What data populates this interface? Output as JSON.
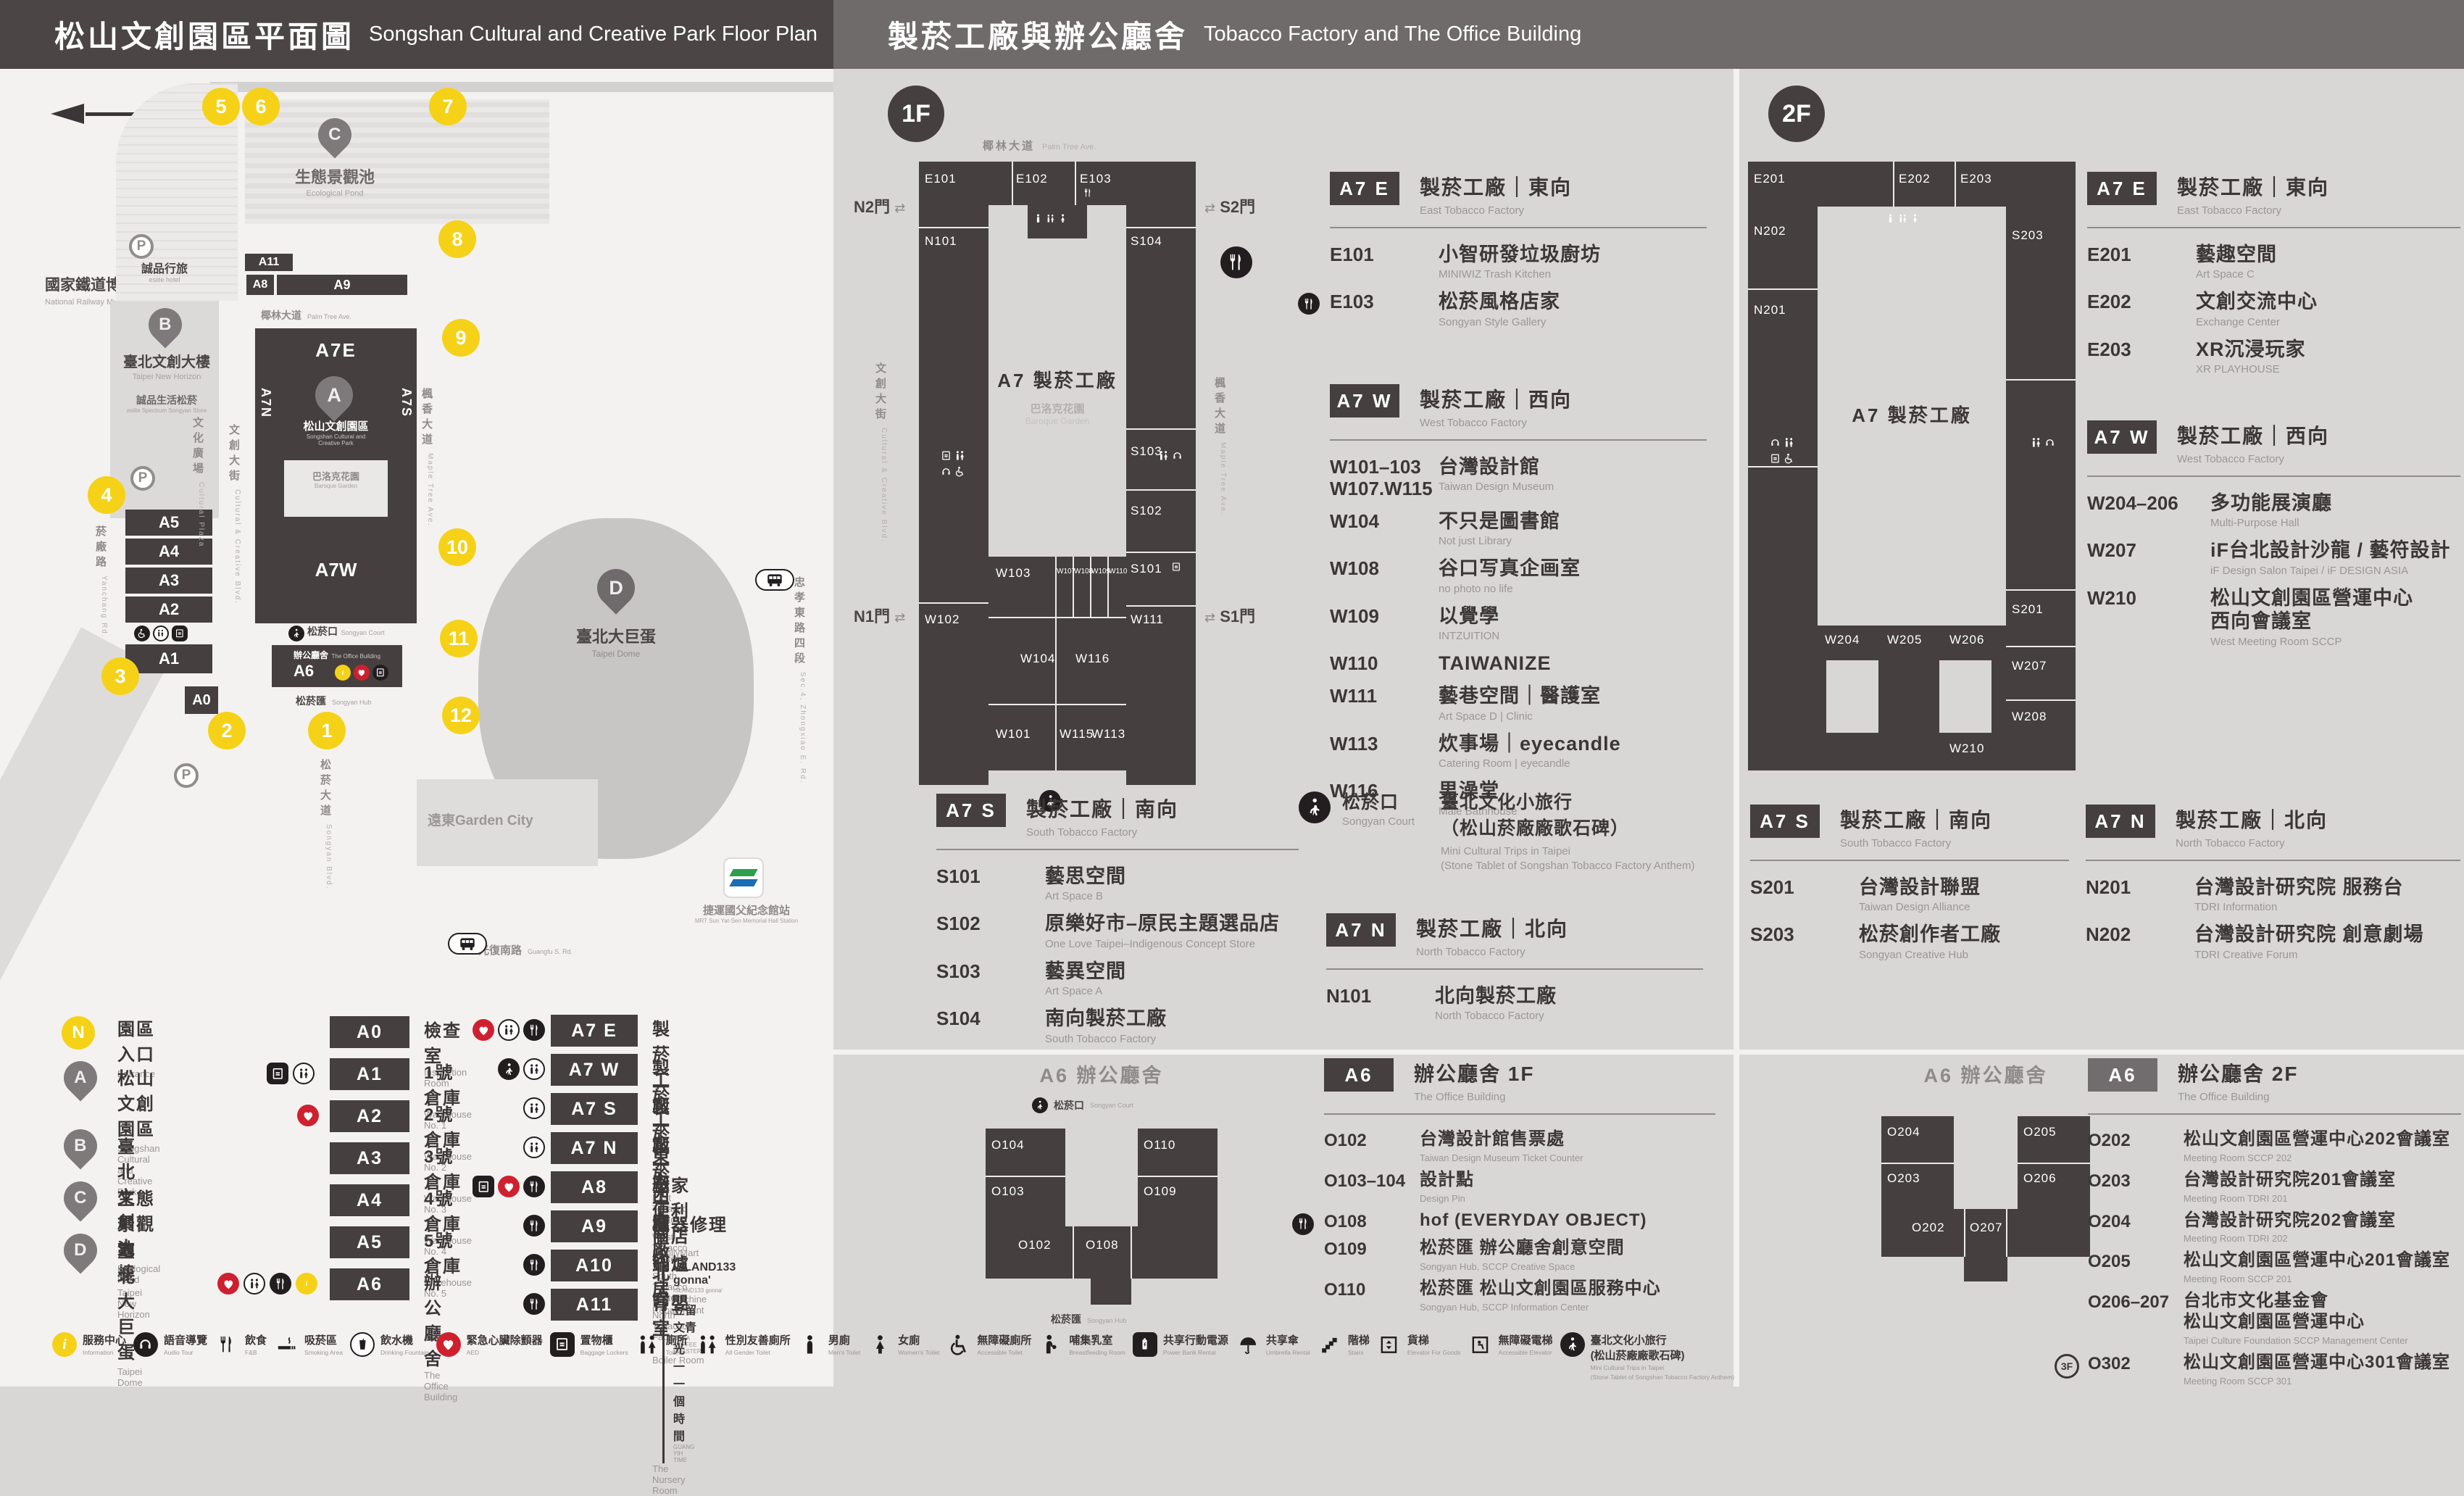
{
  "header": {
    "left_zh": "松山文創園區平面圖",
    "left_en": "Songshan Cultural and Creative Park Floor Plan",
    "right_zh": "製菸工廠與辦公廳舍",
    "right_en": "Tobacco Factory and The Office Building"
  },
  "map": {
    "parking": "P",
    "landmarks": {
      "railway_zh": "國家鐵道博物館",
      "railway_en": "National Railway Museum",
      "eslite_hotel_zh": "誠品行旅",
      "eslite_hotel_en": "eslite hotel",
      "horizon_zh": "臺北文創大樓",
      "horizon_en": "Taipei New Horizon",
      "spectrum_zh": "誠品生活松菸",
      "spectrum_en": "eslite Spectrum Songyan Store",
      "pond_zh": "生態景觀池",
      "pond_en": "Ecological Pond",
      "park_zh": "松山文創園區",
      "park_en1": "Songshan Cultural and",
      "park_en2": "Creative Park",
      "dome_zh": "臺北大巨蛋",
      "dome_en": "Taipei Dome",
      "baroque_zh": "巴洛克花園",
      "baroque_en": "Baroque Garden",
      "court_zh": "松菸口",
      "court_en": "Songyan Court",
      "office_zh": "辦公廳舍",
      "office_en": "The Office Building",
      "hub_zh": "松菸匯",
      "hub_en": "Songyan Hub",
      "mrt_zh": "捷運國父紀念館站",
      "mrt_en": "MRT Sun Yat-Sen Memorial Hall Station",
      "garden_city": "遠東Garden City"
    },
    "streets": {
      "palm_zh": "椰林大道",
      "palm_en": "Palm Tree Ave.",
      "plaza_zh": "文化廣場",
      "plaza_en": "Cultural Plaza",
      "ccblvd_zh": "文創大街",
      "ccblvd_en": "Cultural & Creative Blvd.",
      "maple_zh": "楓香大道",
      "maple_en": "Maple Tree Ave.",
      "yanchang_zh": "菸廠路",
      "yanchang_en": "Yanchang Rd.",
      "guangfu_zh": "光復南路",
      "guangfu_en": "Guangfu S. Rd.",
      "zhongxiao_zh": "忠孝東路四段",
      "zhongxiao_en": "Sec.4, Zhongxiao E. Rd.",
      "songyan_zh": "松菸大道",
      "songyan_en": "Songyan Blvd."
    },
    "blabels": {
      "a11": "A11",
      "a8": "A8",
      "a9": "A9",
      "a7e": "A7E",
      "a7n": "A7N",
      "a7s": "A7S",
      "a7w": "A7W",
      "a6": "A6",
      "a0": "A0",
      "a1": "A1",
      "a2": "A2",
      "a3": "A3",
      "a4": "A4",
      "a5": "A5"
    },
    "entrances": [
      "1",
      "2",
      "3",
      "4",
      "5",
      "6",
      "7",
      "8",
      "9",
      "10",
      "11",
      "12"
    ]
  },
  "legend": {
    "pins": [
      {
        "key": "N",
        "zh": "園區入口",
        "en": "Entrance"
      },
      {
        "key": "A",
        "zh": "松山文創園區",
        "en": "Songshan Cultural",
        "en2": "and Creative Park"
      },
      {
        "key": "B",
        "zh": "臺北文創大樓",
        "en": "Taipei New Horizon"
      },
      {
        "key": "C",
        "zh": "生態景觀池",
        "en": "Ecological Pond"
      },
      {
        "key": "D",
        "zh": "臺北大巨蛋",
        "en": "Taipei Dome"
      }
    ],
    "groupA": [
      {
        "code": "A0",
        "zh": "檢查室",
        "en": "Inspection Room"
      },
      {
        "code": "A1",
        "zh": "1號倉庫",
        "en": "Warehouse No. 1"
      },
      {
        "code": "A2",
        "zh": "2號倉庫",
        "en": "Warehouse No. 2"
      },
      {
        "code": "A3",
        "zh": "3號倉庫",
        "en": "Warehouse No. 3"
      },
      {
        "code": "A4",
        "zh": "4號倉庫",
        "en": "Warehouse No. 4"
      },
      {
        "code": "A5",
        "zh": "5號倉庫",
        "en": "Warehouse No. 5"
      },
      {
        "code": "A6",
        "zh": "辦公廳舍",
        "en": "The Office Building"
      }
    ],
    "groupB": [
      {
        "code": "A7 E",
        "zh": "製菸工廠｜東向",
        "en": "East Tobacco Factory"
      },
      {
        "code": "A7 W",
        "zh": "製菸工廠｜西向",
        "en": "West Tobacco Factory"
      },
      {
        "code": "A7 S",
        "zh": "製菸工廠｜南向",
        "en": "South Tobacco Factory"
      },
      {
        "code": "A7 N",
        "zh": "製菸工廠｜北向",
        "en": "North Tobacco Factory"
      },
      {
        "code": "A8",
        "zh": "全家便利商店",
        "en": "FamilyMart"
      },
      {
        "code": "A9",
        "zh": "機器修理廠",
        "extra_zh": "ISLAND133 gonna'",
        "extra_en": "ISLAND133 gonna'",
        "en": "The Machine Repair Plant"
      },
      {
        "code": "A10",
        "zh": "鍋爐房",
        "extra_zh": "豆留文青",
        "extra_en": "CAMA COFFEE ROASTERS",
        "en": "Boiler Room"
      },
      {
        "code": "A11",
        "zh": "育嬰室",
        "extra_zh": "光一 一個時間",
        "extra_en": "GUANG YIH TIME",
        "en": "The Nursery Room"
      }
    ]
  },
  "facilities": [
    {
      "zh": "服務中心",
      "en": "Information"
    },
    {
      "zh": "語音導覽",
      "en": "Audio Tour"
    },
    {
      "zh": "飲食",
      "en": "F&B"
    },
    {
      "zh": "吸菸區",
      "en": "Smoking Area"
    },
    {
      "zh": "飲水機",
      "en": "Drinking Fountain"
    },
    {
      "zh": "緊急心臟除顫器",
      "en": "AED"
    },
    {
      "zh": "置物櫃",
      "en": "Baggage Lockers"
    },
    {
      "zh": "廁所",
      "en": "Toilet"
    },
    {
      "zh": "性別友善廁所",
      "en": "All Gender Toilet"
    },
    {
      "zh": "男廁",
      "en": "Men's Toilet"
    },
    {
      "zh": "女廁",
      "en": "Women's Toilet"
    },
    {
      "zh": "無障礙廁所",
      "en": "Accessible Toilet"
    },
    {
      "zh": "哺集乳室",
      "en": "Breastfeeding Room"
    },
    {
      "zh": "共享行動電源",
      "en": "Power Bank Rental"
    },
    {
      "zh": "共享傘",
      "en": "Umbrella Rental"
    },
    {
      "zh": "階梯",
      "en": "Stairs"
    },
    {
      "zh": "貨梯",
      "en": "Elevator For Goods"
    },
    {
      "zh": "無障礙電梯",
      "en": "Accessible Elevator"
    },
    {
      "zh": "臺北文化小旅行",
      "zh2": "(松山菸廠廠歌石碑)",
      "en": "Mini Cultural Trips in Taipei",
      "en2": "(Stone Tablet of Songshan Tobacco Factory Anthem)"
    }
  ],
  "floor1": {
    "badge": "1F",
    "plan": {
      "street_top_zh": "椰林大道",
      "street_top_en": "Palm Tree Ave.",
      "street_left_zh": "文創大街",
      "street_left_en": "Cultural & Creative Blvd.",
      "street_right_zh": "楓香大道",
      "street_right_en": "Maple Tree Ave.",
      "gate_n2": "N2門",
      "gate_s2": "S2門",
      "gate_n1": "N1門",
      "gate_s1": "S1門",
      "center": "A7 製菸工廠",
      "garden_zh": "巴洛克花園",
      "garden_en": "Baroque Garden",
      "rooms": [
        "E101",
        "E102",
        "E103",
        "N101",
        "S104",
        "S103",
        "S102",
        "S101",
        "W102",
        "W103",
        "W104",
        "W107",
        "W108",
        "W109",
        "W110",
        "W111",
        "W116",
        "W101",
        "W115",
        "W113"
      ]
    },
    "a7e": {
      "badge": "A7 E",
      "tzh": "製菸工廠｜東向",
      "ten": "East Tobacco Factory",
      "rooms": [
        {
          "code": "E101",
          "zh": "小智研發垃圾廚坊",
          "en": "MINIWIZ Trash Kitchen"
        },
        {
          "code": "E103",
          "zh": "松菸風格店家",
          "en": "Songyan Style Gallery"
        }
      ]
    },
    "a7w": {
      "badge": "A7 W",
      "tzh": "製菸工廠｜西向",
      "ten": "West Tobacco Factory",
      "rooms": [
        {
          "code": "W101–103",
          "code2": "W107.W115",
          "zh": "台灣設計館",
          "en": "Taiwan Design Museum"
        },
        {
          "code": "W104",
          "zh": "不只是圖書館",
          "en": "Not just Library"
        },
        {
          "code": "W108",
          "zh": "谷口写真企画室",
          "en": "no photo no life"
        },
        {
          "code": "W109",
          "zh": "以覺學",
          "en": "INTZUITION"
        },
        {
          "code": "W110",
          "zh": "TAIWANIZE",
          "en": ""
        },
        {
          "code": "W111",
          "zh": "藝巷空間｜醫護室",
          "en": "Art Space D | Clinic"
        },
        {
          "code": "W113",
          "zh": "炊事場｜eyecandle",
          "en": "Catering Room | eyecandle"
        },
        {
          "code": "W116",
          "zh": "男澡堂",
          "en": "Male Bathhouse"
        }
      ]
    },
    "a7s": {
      "badge": "A7 S",
      "tzh": "製菸工廠｜南向",
      "ten": "South Tobacco Factory",
      "rooms": [
        {
          "code": "S101",
          "zh": "藝思空間",
          "en": "Art Space B"
        },
        {
          "code": "S102",
          "zh": "原樂好市–原民主題選品店",
          "en": "One Love Taipei–Indigenous Concept Store"
        },
        {
          "code": "S103",
          "zh": "藝異空間",
          "en": "Art Space A"
        },
        {
          "code": "S104",
          "zh": "南向製菸工廠",
          "en": "South Tobacco Factory"
        }
      ]
    },
    "court": {
      "zh": "松菸口",
      "en": "Songyan Court",
      "t1": "臺北文化小旅行",
      "t2": "（松山菸廠廠歌石碑）",
      "e1": "Mini Cultural Trips in Taipei",
      "e2": "(Stone Tablet of Songshan Tobacco Factory Anthem)"
    },
    "a7n": {
      "badge": "A7 N",
      "tzh": "製菸工廠｜北向",
      "ten": "North Tobacco Factory",
      "rooms": [
        {
          "code": "N101",
          "zh": "北向製菸工廠",
          "en": "North Tobacco Factory"
        }
      ]
    },
    "a6": {
      "badge": "A6",
      "tzh": "辦公廳舍 1F",
      "ten": "The Office Building",
      "rooms": [
        {
          "code": "O102",
          "zh": "台灣設計館售票處",
          "en": "Taiwan Design Museum Ticket Counter"
        },
        {
          "code": "O103–104",
          "zh": "設計點",
          "en": "Design Pin"
        },
        {
          "code": "O108",
          "zh": "hof (EVERYDAY OBJECT)",
          "en": ""
        },
        {
          "code": "O109",
          "zh": "松菸匯 辦公廳舍創意空間",
          "en": "Songyan Hub, SCCP Creative Space"
        },
        {
          "code": "O110",
          "zh": "松菸匯 松山文創園區服務中心",
          "en": "Songyan Hub, SCCP Information Center"
        }
      ]
    },
    "a6plan": {
      "title": "A6 辦公廳舍",
      "court_zh": "松菸口",
      "court_en": "Songyan Court",
      "hub_zh": "松菸匯",
      "hub_en": "Songyan Hub",
      "rooms": [
        "O104",
        "O103",
        "O102",
        "O110",
        "O109",
        "O108"
      ]
    }
  },
  "floor2": {
    "badge": "2F",
    "plan": {
      "center": "A7 製菸工廠",
      "rooms": [
        "E201",
        "E202",
        "E203",
        "N202",
        "N201",
        "S203",
        "S201",
        "W204",
        "W205",
        "W206",
        "W207",
        "W208",
        "W210"
      ]
    },
    "a7e": {
      "badge": "A7 E",
      "tzh": "製菸工廠｜東向",
      "ten": "East Tobacco Factory",
      "rooms": [
        {
          "code": "E201",
          "zh": "藝趣空間",
          "en": "Art Space C"
        },
        {
          "code": "E202",
          "zh": "文創交流中心",
          "en": "Exchange Center"
        },
        {
          "code": "E203",
          "zh": "XR沉浸玩家",
          "en": "XR PLAYHOUSE"
        }
      ]
    },
    "a7w": {
      "badge": "A7 W",
      "tzh": "製菸工廠｜西向",
      "ten": "West Tobacco Factory",
      "rooms": [
        {
          "code": "W204–206",
          "zh": "多功能展演廳",
          "en": "Multi-Purpose Hall"
        },
        {
          "code": "W207",
          "zh": "iF台北設計沙龍 / 藝符設計",
          "en": "iF Design Salon Taipei / iF DESIGN ASIA"
        },
        {
          "code": "W210",
          "zh": "松山文創園區營運中心",
          "zh2": "西向會議室",
          "en": "West Meeting Room SCCP"
        }
      ]
    },
    "a7s": {
      "badge": "A7 S",
      "tzh": "製菸工廠｜南向",
      "ten": "South Tobacco Factory",
      "rooms": [
        {
          "code": "S201",
          "zh": "台灣設計聯盟",
          "en": "Taiwan Design Alliance"
        },
        {
          "code": "S203",
          "zh": "松菸創作者工廠",
          "en": "Songyan Creative Hub"
        }
      ]
    },
    "a7n": {
      "badge": "A7 N",
      "tzh": "製菸工廠｜北向",
      "ten": "North Tobacco Factory",
      "rooms": [
        {
          "code": "N201",
          "zh": "台灣設計研究院 服務台",
          "en": "TDRI Information"
        },
        {
          "code": "N202",
          "zh": "台灣設計研究院 創意劇場",
          "en": "TDRI Creative Forum"
        }
      ]
    },
    "a6": {
      "badge": "A6",
      "tzh": "辦公廳舍 2F",
      "ten": "The Office Building",
      "rooms": [
        {
          "code": "O202",
          "zh": "松山文創園區營運中心202會議室",
          "en": "Meeting Room SCCP 202"
        },
        {
          "code": "O203",
          "zh": "台灣設計研究院201會議室",
          "en": "Meeting Room TDRI 201"
        },
        {
          "code": "O204",
          "zh": "台灣設計研究院202會議室",
          "en": "Meeting Room TDRI 202"
        },
        {
          "code": "O205",
          "zh": "松山文創園區營運中心201會議室",
          "en": "Meeting Room SCCP 201"
        },
        {
          "code": "O206–207",
          "zh": "台北市文化基金會",
          "zh2": "松山文創園區營運中心",
          "en": "Taipei Culture Foundation SCCP Management Center"
        },
        {
          "code": "O302",
          "prefix": "3F",
          "zh": "松山文創園區營運中心301會議室",
          "en": "Meeting Room SCCP 301"
        }
      ]
    },
    "a6plan": {
      "title": "A6 辦公廳舍",
      "rooms": [
        "O204",
        "O203",
        "O202",
        "O207",
        "O206",
        "O205"
      ]
    }
  }
}
